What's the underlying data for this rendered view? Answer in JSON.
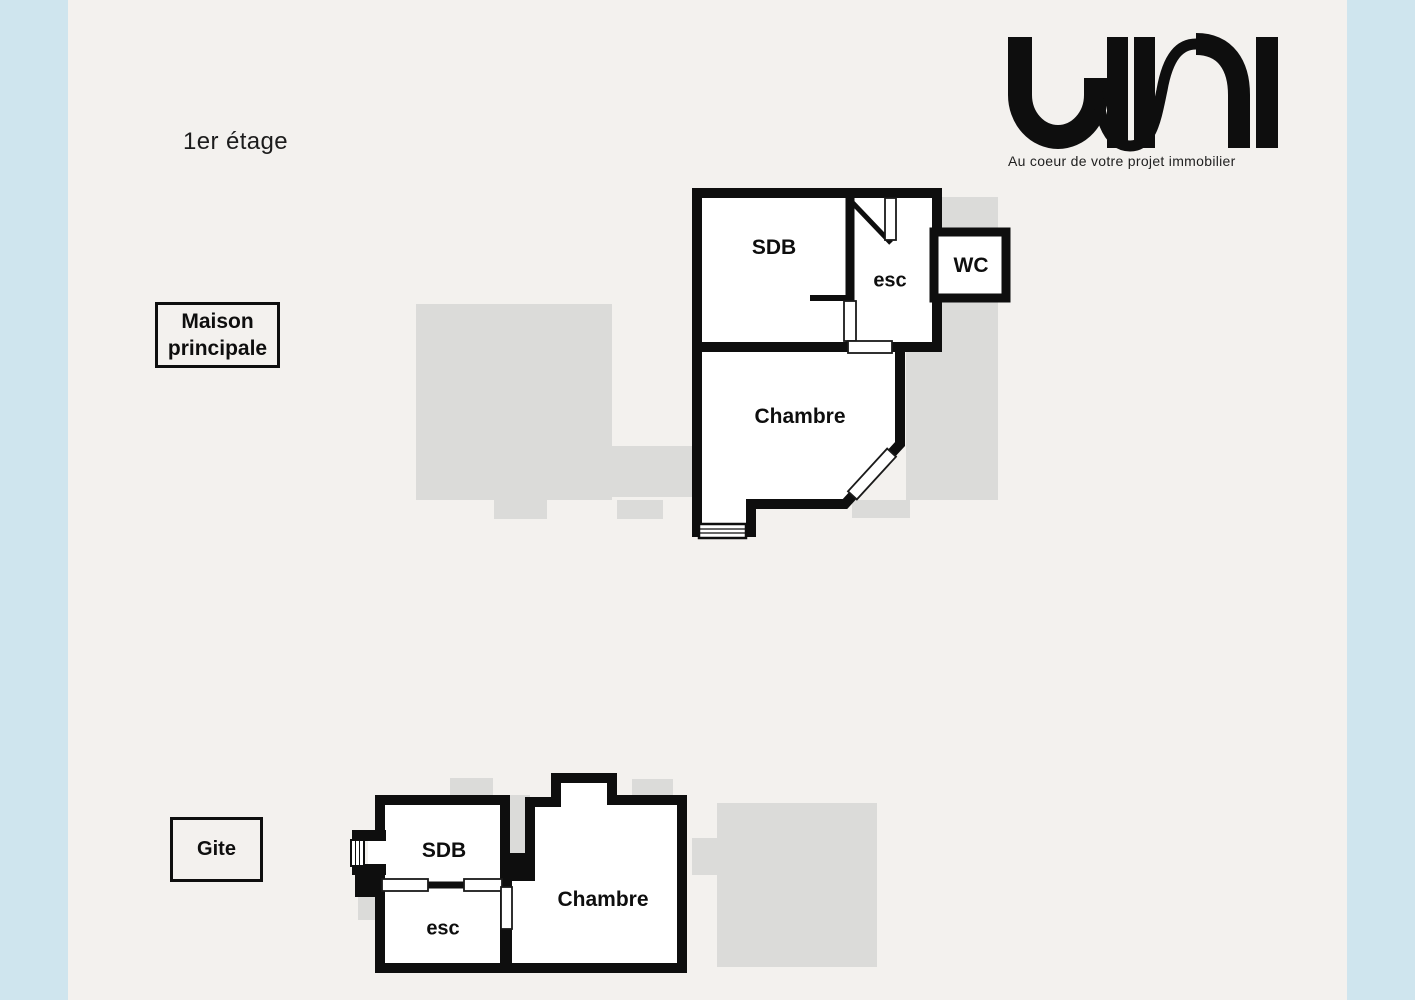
{
  "page": {
    "floor_label": "1er étage"
  },
  "logo": {
    "text": "uni",
    "tagline": "Au coeur de votre projet immobilier"
  },
  "colors": {
    "background": "#f3f1ee",
    "side_panels": "#cfe5ee",
    "walls": "#0e0e0e",
    "ground_floor_silhouette": "#dbdbd9"
  },
  "buildings": {
    "maison": {
      "label_line1": "Maison",
      "label_line2": "principale",
      "rooms": {
        "sdb": "SDB",
        "esc": "esc",
        "wc": "WC",
        "chambre": "Chambre"
      }
    },
    "gite": {
      "label": "Gite",
      "rooms": {
        "sdb": "SDB",
        "esc": "esc",
        "chambre": "Chambre"
      }
    }
  }
}
